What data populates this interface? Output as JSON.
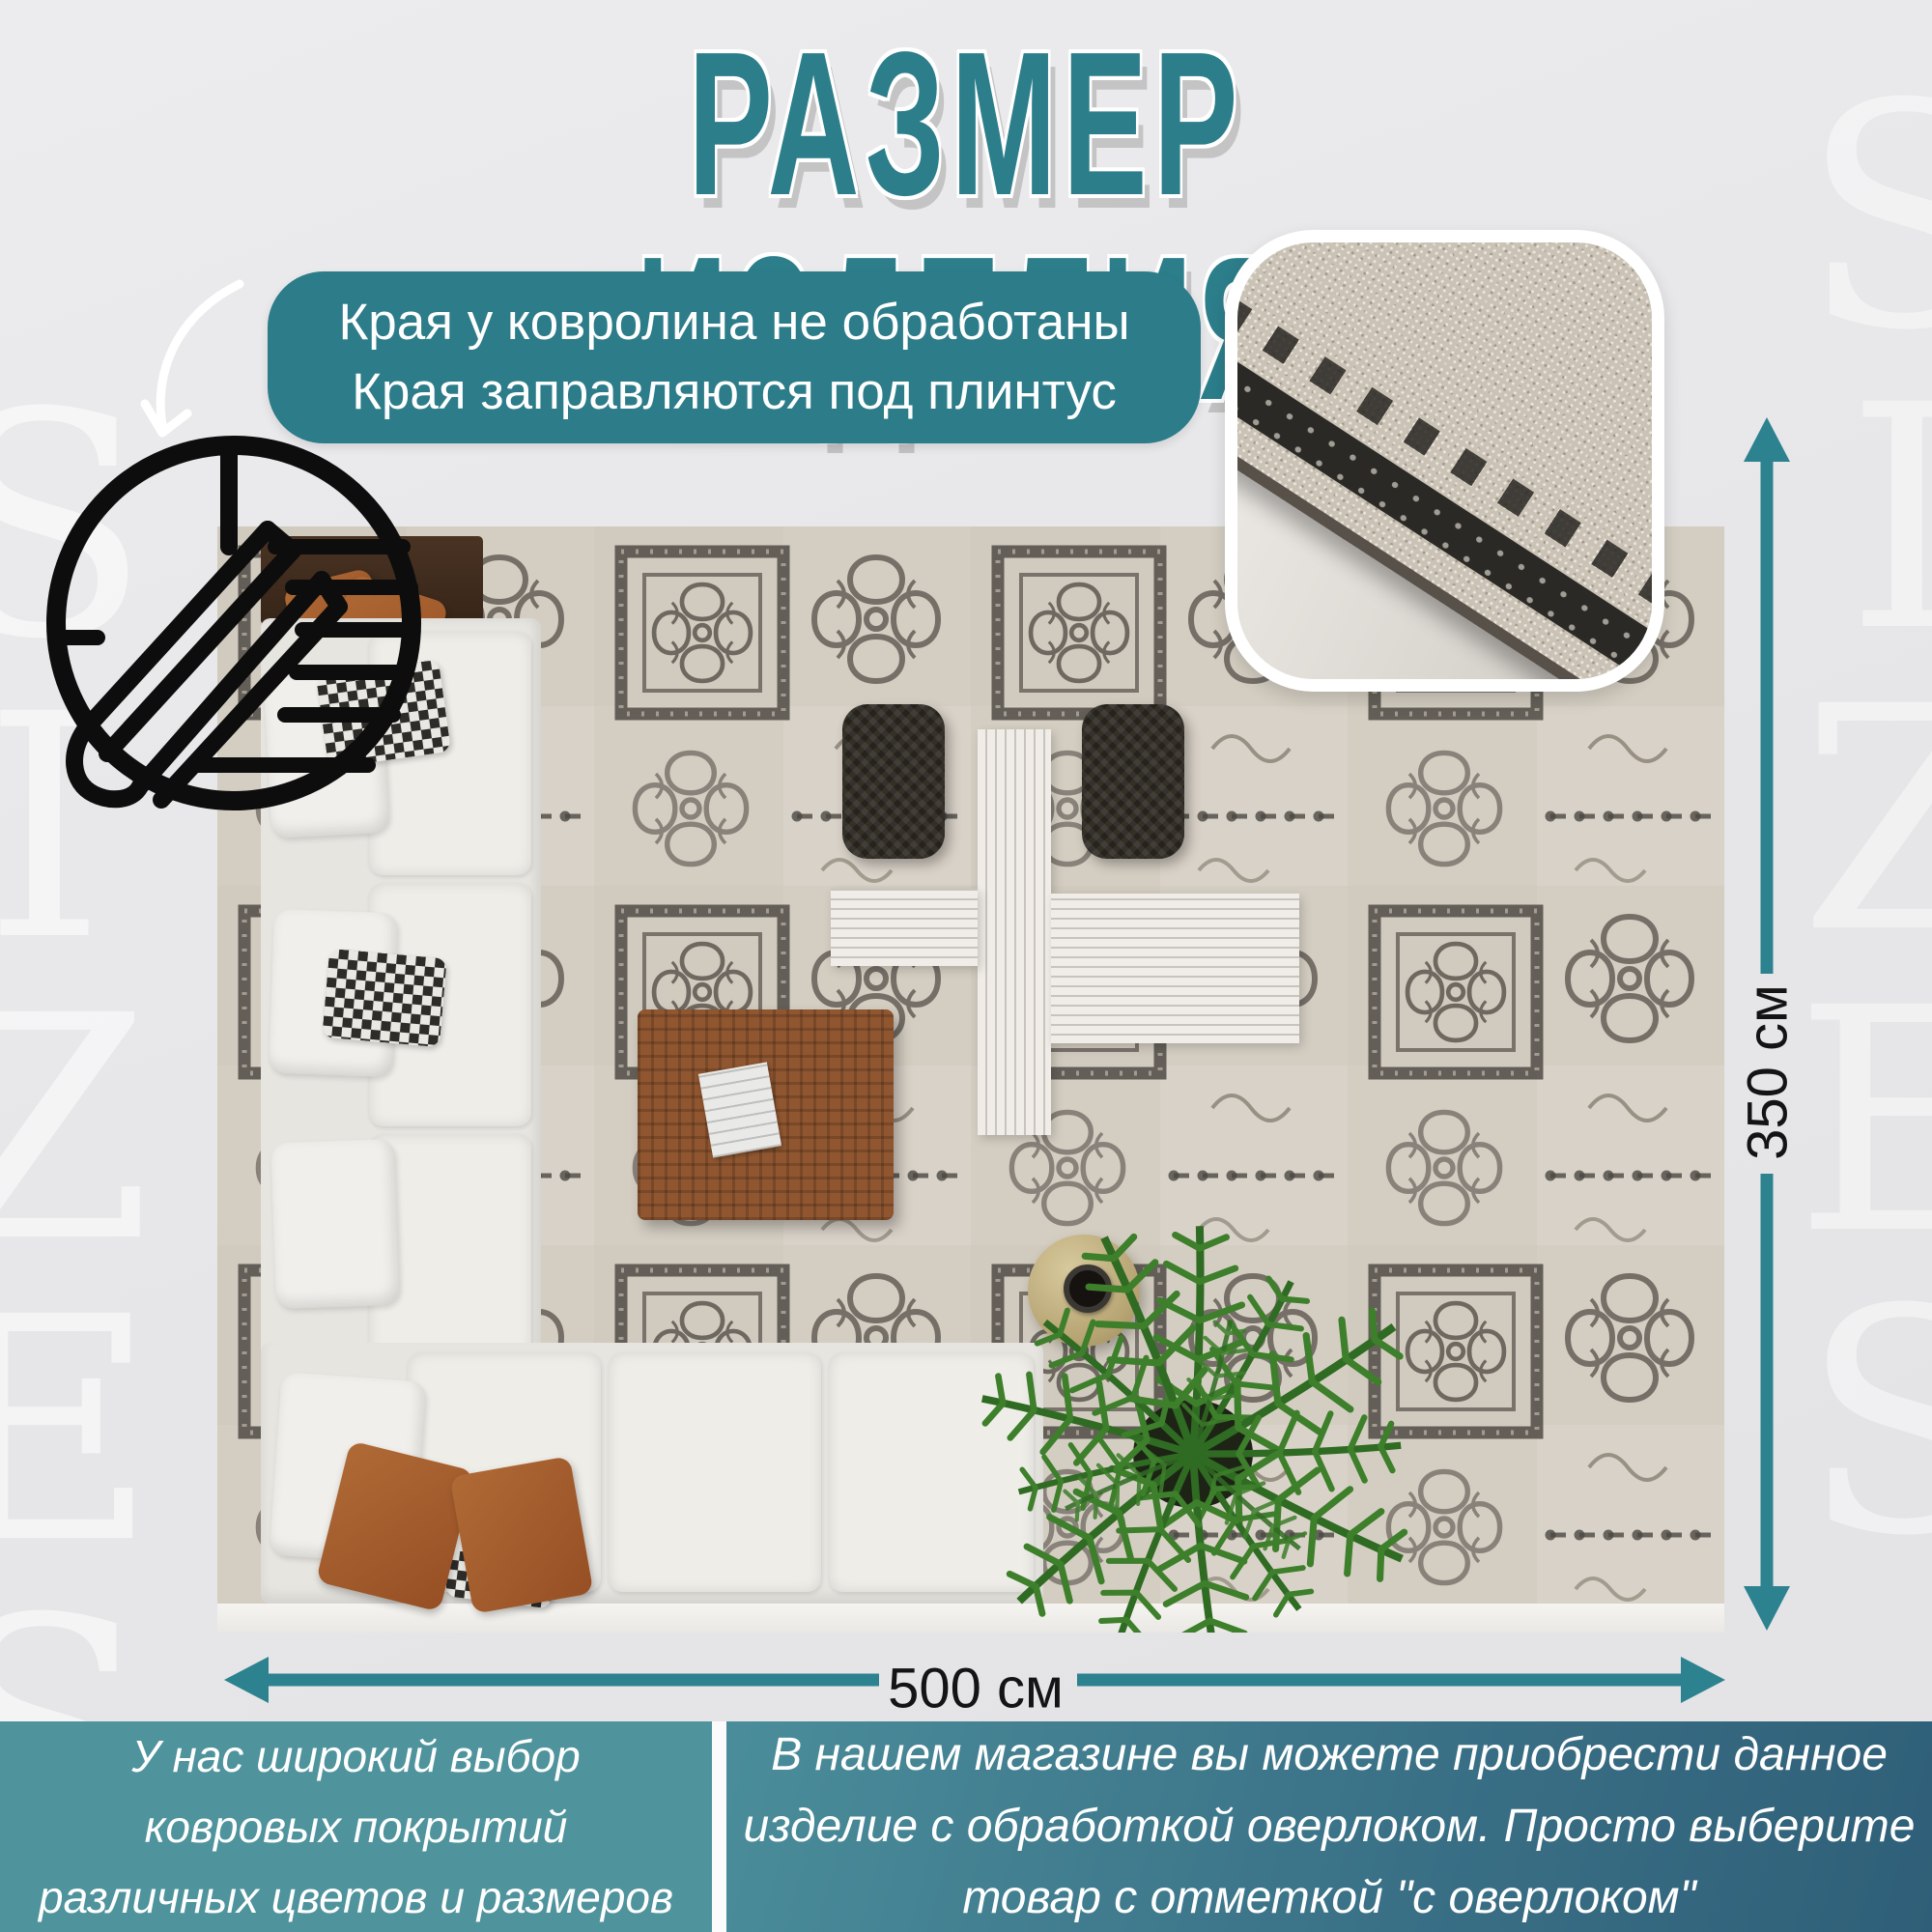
{
  "page": {
    "title": "РАЗМЕР ИЗДЕЛИЯ",
    "watermark": "SIZES"
  },
  "callout": {
    "line1": "Края у ковролина не обработаны",
    "line2": "Края заправляются под плинтус"
  },
  "dimensions": {
    "width_label": "500 см",
    "height_label": "350 см"
  },
  "footer": {
    "left": {
      "lines": [
        "У нас широкий выбор",
        "ковровых покрытий",
        "различных цветов и размеров"
      ]
    },
    "right": {
      "lines": [
        "В нашем магазине вы можете приобрести данное",
        "изделие с обработкой оверлоком. Просто выберите",
        "товар с отметкой \"с оверлоком\""
      ]
    }
  },
  "colors": {
    "accent_teal": "#2c7e8b",
    "bubble_teal": "#2c7c89",
    "arrow_teal": "#2c828f",
    "footer_left": "#4f939d",
    "footer_right_start": "#4a8d9a",
    "footer_right_end": "#2f5f78",
    "dimension_text": "#141414"
  }
}
